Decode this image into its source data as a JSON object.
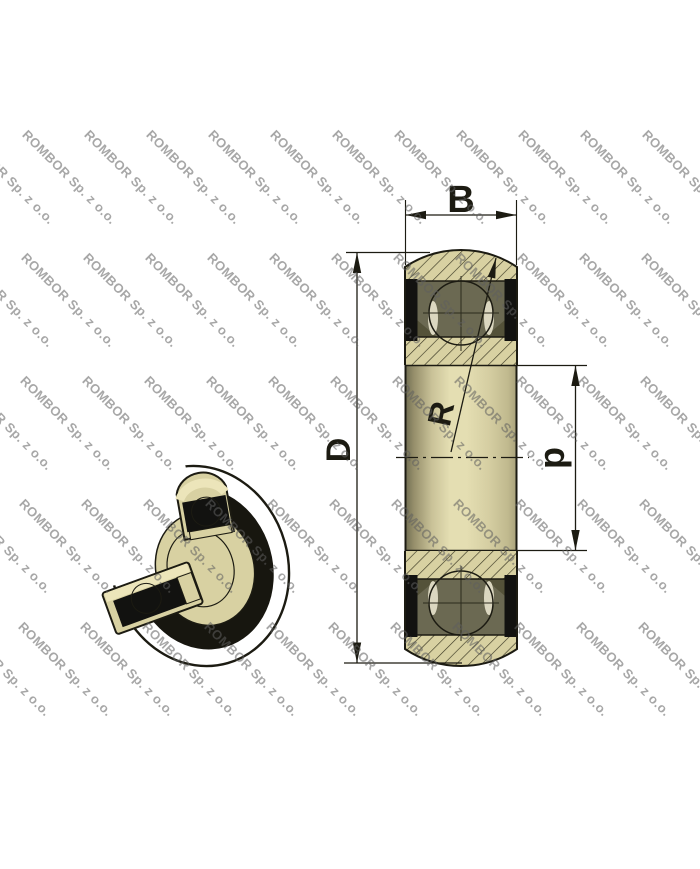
{
  "image_title": "Sealed spherical-outer-ring ball bearing - dimensional drawing",
  "watermark": {
    "text": "ROMBOR Sp. z o.o.",
    "angle_deg": 45,
    "x0": 92,
    "y0": 127,
    "col_step": 62,
    "diag_step": 123,
    "col_min": -10,
    "col_max": 9,
    "row_min": 0,
    "row_max": 4,
    "x_min": -150,
    "x_max": 692
  },
  "drawing": {
    "labels": {
      "width": "B",
      "outer_diameter": "D",
      "bore_diameter": "d",
      "sphere_radius": "R"
    }
  },
  "colors": {
    "wm_color": "rgba(95,95,95,0.55)",
    "outline": "#1c1b12",
    "hatch_line": "#35331f",
    "material": "#d8d1a2",
    "material_light": "#ece5ba",
    "material_dark": "#9b9570",
    "body_deep_shadow": "#8a8462",
    "cavity": "#6b6952",
    "cavity_shadow": "#545239",
    "seal": "#121210",
    "band_black": "#17160f",
    "ball_light": "#eee8c6",
    "ball_mid": "#d6cf9f",
    "ball_dark": "#99926c",
    "sliver": "#dbd7c0",
    "crosshair": "#2b2a1c",
    "bore_edge_dark": "#6f6c51",
    "bore_mid_dark": "#968f6b",
    "bore_light": "#e4deb2",
    "bore_right": "#a8a17a",
    "bore_hole_light": "#cfc99b",
    "bore_hole_dark": "#262519"
  }
}
